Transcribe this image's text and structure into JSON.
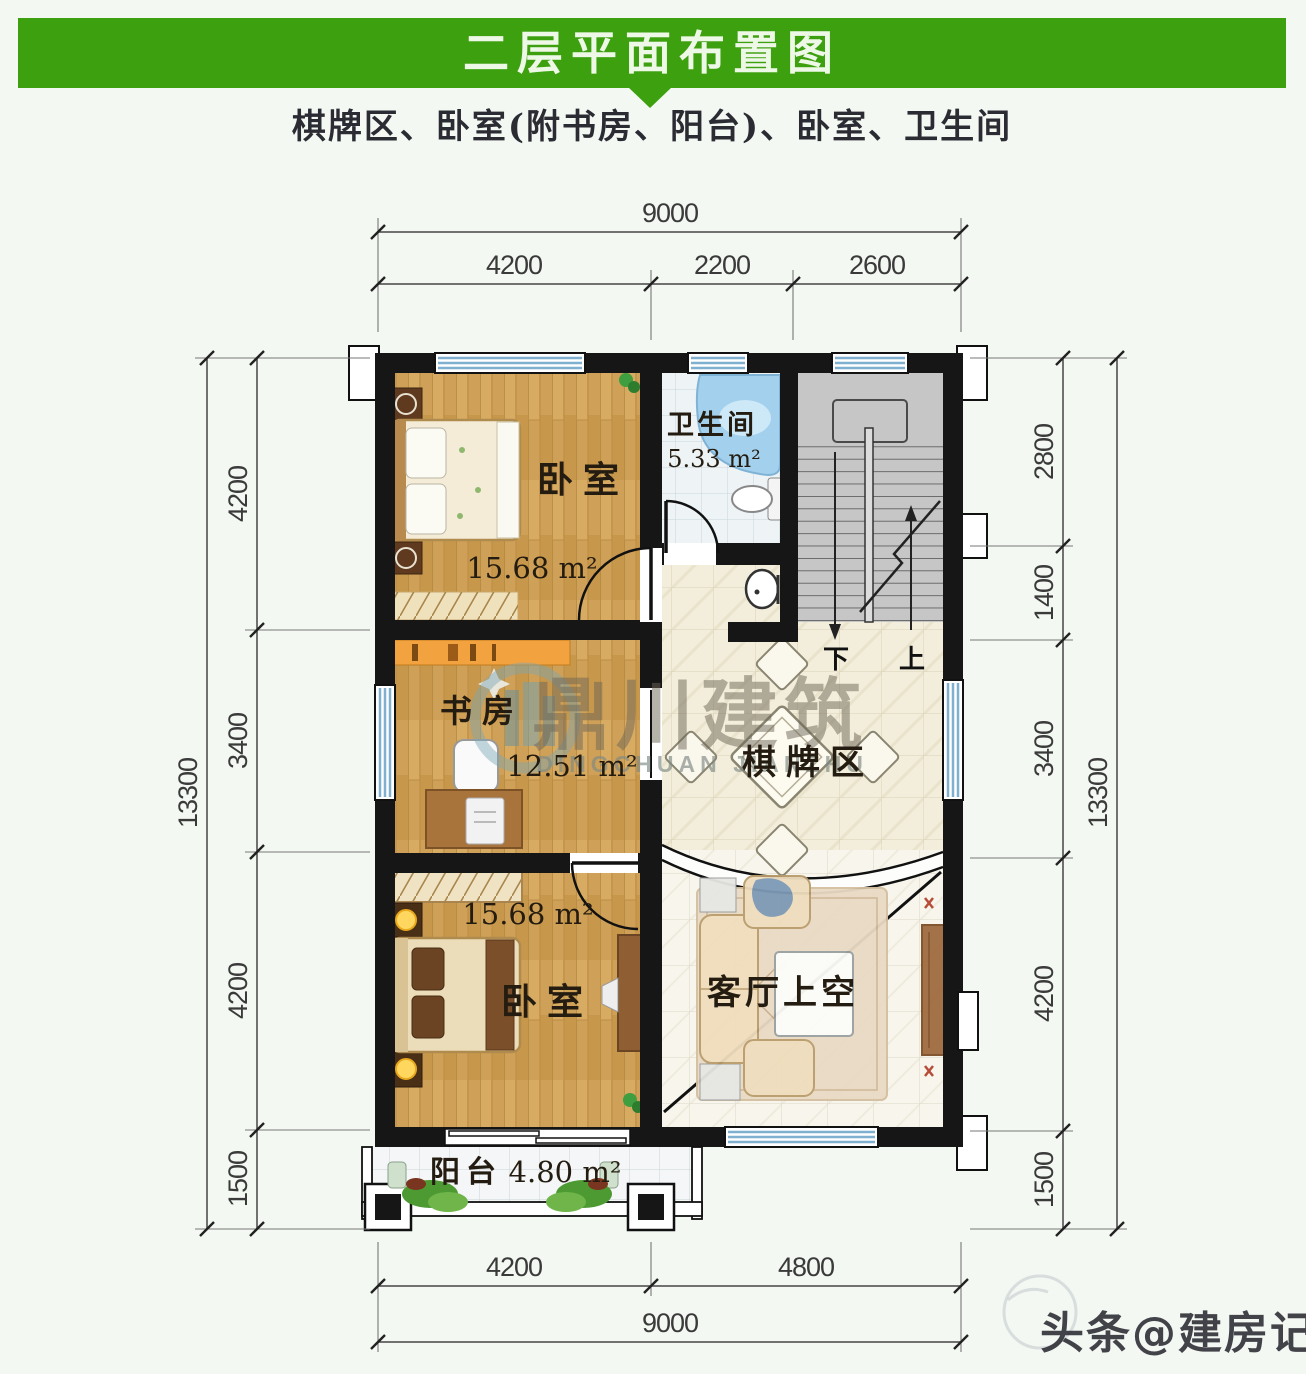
{
  "header": {
    "title": "二层平面布置图"
  },
  "subtitle": "棋牌区、卧室(附书房、阳台)、卧室、卫生间",
  "dimensions": {
    "top": {
      "overall": "9000",
      "segments": [
        "4200",
        "2200",
        "2600"
      ]
    },
    "bottom": {
      "overall": "9000",
      "segments": [
        "4200",
        "4800"
      ]
    },
    "left": {
      "overall": "13300",
      "segments": [
        "4200",
        "3400",
        "4200",
        "1500"
      ]
    },
    "right": {
      "overall": "13300",
      "segments": [
        "2800",
        "1400",
        "3400",
        "4200",
        "1500"
      ]
    }
  },
  "rooms": {
    "bedroom_top": {
      "name": "卧室",
      "area": "15.68 m²"
    },
    "bathroom": {
      "name": "卫生间",
      "area": "5.33 m²"
    },
    "study": {
      "name": "书房",
      "area": "12.51 m²"
    },
    "game_area": {
      "name": "棋牌区"
    },
    "bedroom_bottom": {
      "name": "卧室",
      "area": "15.68 m²"
    },
    "living_void": {
      "name": "客厅上空"
    },
    "balcony": {
      "name": "阳台",
      "area": "4.80 m²"
    }
  },
  "stairs": {
    "down_label": "下",
    "up_label": "上"
  },
  "watermark": {
    "brand_cn": "鼎川建筑",
    "brand_en": "DINGCHUAN JIANZHU"
  },
  "footer": {
    "watermark": "头条@建房记"
  },
  "colors": {
    "header_green": "#3da00f",
    "wall_black": "#161616",
    "wood_floor": "#cfa057",
    "tile_cream": "#f3eedb",
    "stair_gray": "#c6c6c6",
    "window_blue": "#7fb0cf",
    "bathtub_blue": "#a3d0ec"
  }
}
